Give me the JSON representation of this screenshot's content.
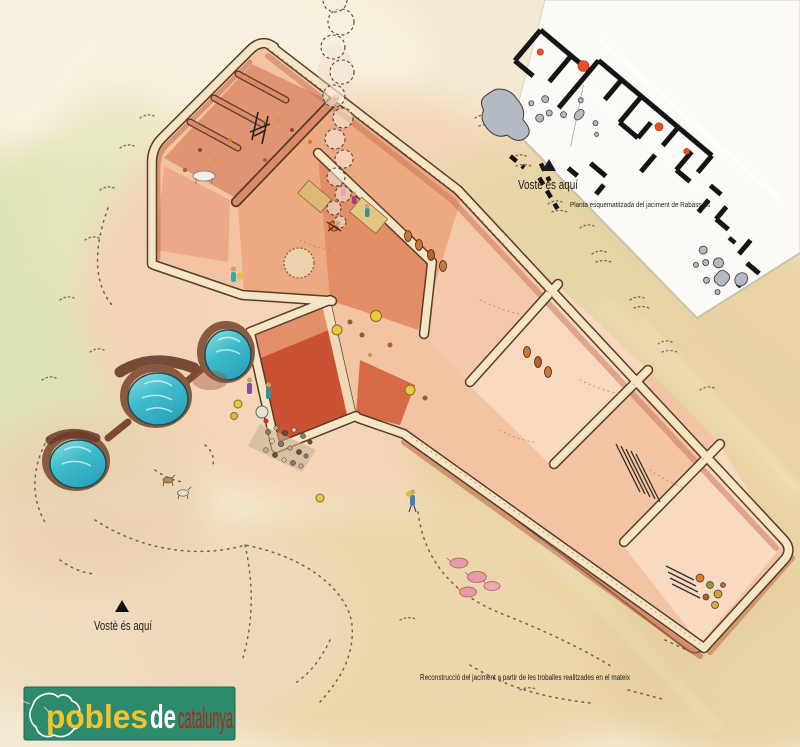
{
  "panel": {
    "inset": {
      "you_are_here_label": "Vostè és aquí",
      "caption": "Planta esquematitzada del jaciment de Rabassats"
    },
    "ground_marker": {
      "you_are_here_label": "Vostè és aquí"
    },
    "footer_caption": "Reconstrucció del jaciment a partir de  les troballes realitzades en el mateix",
    "logo": {
      "word_pobles": "pobles",
      "word_de": "de",
      "word_catalunya": "catalunya"
    },
    "colors": {
      "paper_cream": "#f3ead3",
      "wash_green": "#dce3b0",
      "wash_rose": "#f4d2b4",
      "wash_tan": "#e9d2a2",
      "wall_terracotta": "#c87454",
      "wall_red": "#cb5134",
      "wall_top_cream": "#f4e6c5",
      "water_turquoise": "#3fbccb",
      "cistern_rim_brown": "#7c4a34",
      "plan_wall_black": "#151515",
      "plan_find_orange": "#e8502a",
      "plan_stone_gray": "#b4bac4",
      "logo_green": "#2d8a6c",
      "logo_yellow": "#f2c52e",
      "logo_white": "#ffffff",
      "logo_red": "#b1231a"
    }
  }
}
